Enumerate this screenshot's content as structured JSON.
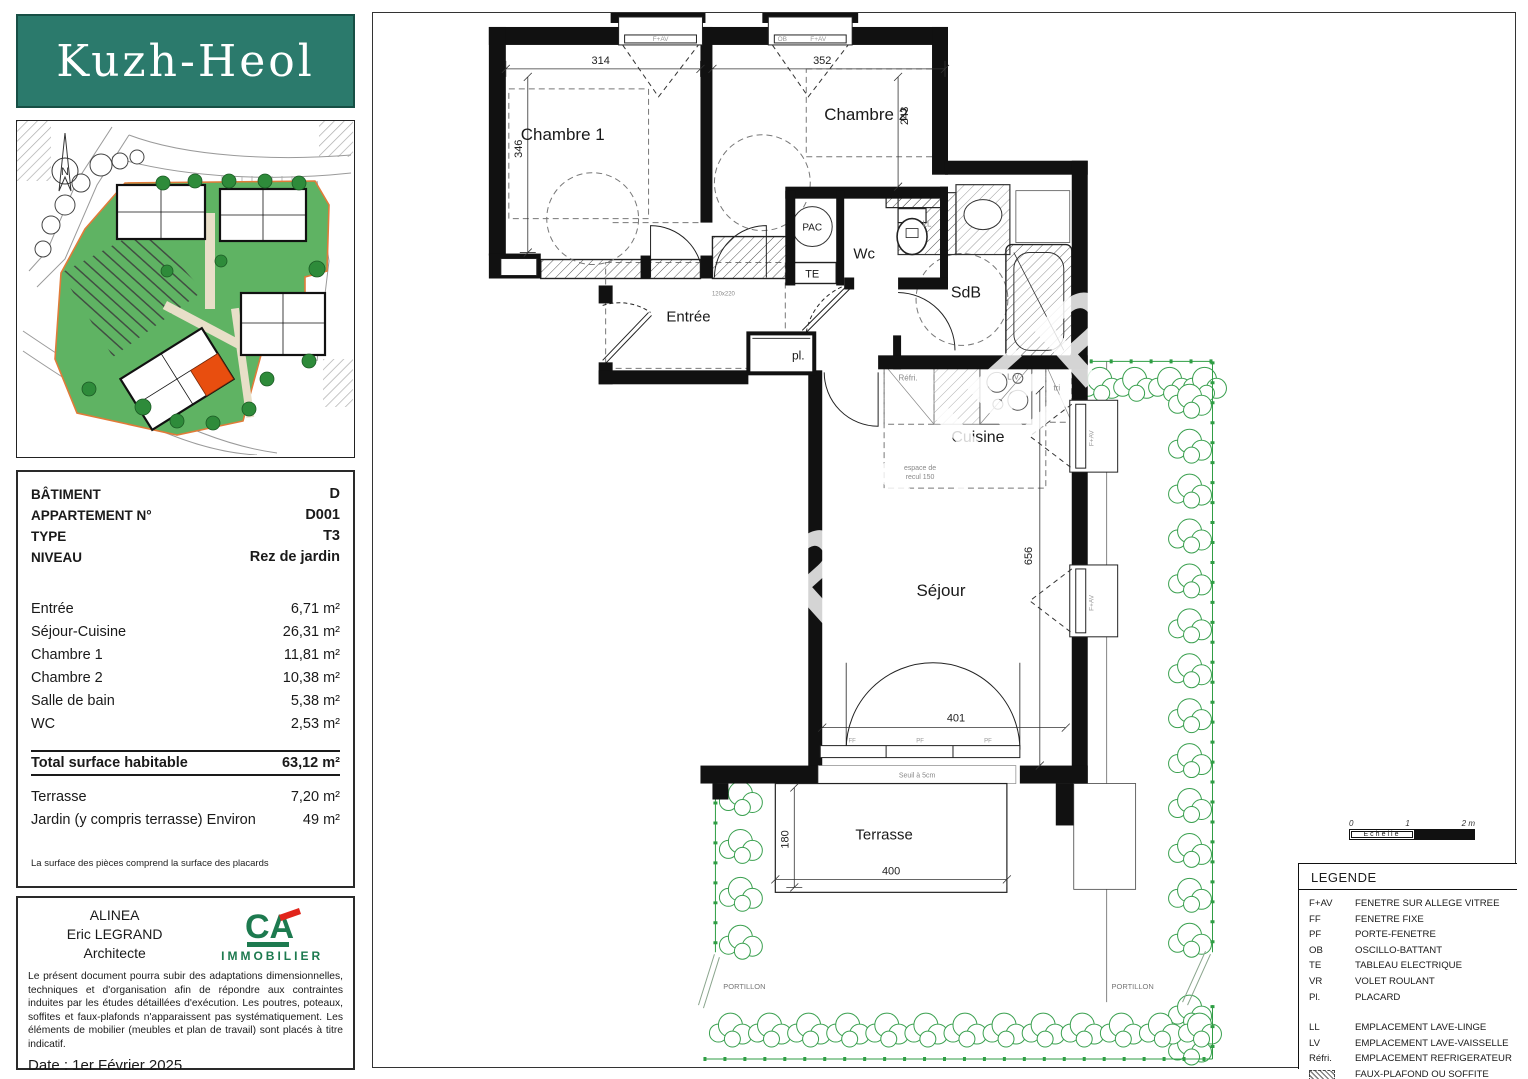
{
  "logo": {
    "title": "Kuzh-Heol"
  },
  "site_plan": {
    "north": "N"
  },
  "info_panel": {
    "header": [
      {
        "label": "BÂTIMENT",
        "value": "D"
      },
      {
        "label": "APPARTEMENT N°",
        "value": "D001"
      },
      {
        "label": "TYPE",
        "value": "T3"
      },
      {
        "label": "NIVEAU",
        "value": "Rez de jardin"
      }
    ],
    "rooms": [
      {
        "label": "Entrée",
        "value": "6,71 m²"
      },
      {
        "label": "Séjour-Cuisine",
        "value": "26,31 m²"
      },
      {
        "label": "Chambre 1",
        "value": "11,81 m²"
      },
      {
        "label": "Chambre 2",
        "value": "10,38 m²"
      },
      {
        "label": "Salle de bain",
        "value": "5,38 m²"
      },
      {
        "label": "WC",
        "value": "2,53 m²"
      }
    ],
    "total": {
      "label": "Total surface habitable",
      "value": "63,12 m²"
    },
    "outdoor": [
      {
        "label": "Terrasse",
        "value": "7,20 m²"
      },
      {
        "label": "Jardin (y compris terrasse) Environ",
        "value": "49 m²"
      }
    ],
    "footnote": "La surface des pièces comprend la surface des placards"
  },
  "architect_panel": {
    "line1": "ALINEA",
    "line2": "Eric LEGRAND",
    "line3": "Architecte",
    "ca": "CA",
    "immobilier": "IMMOBILIER",
    "disclaimer": "Le présent document pourra subir des adaptations dimensionnelles, techniques et d'organisation afin de répondre aux contraintes induites par les études détaillées d'exécution. Les poutres, poteaux, soffites et faux-plafonds n'apparaissent pas systématiquement. Les éléments de mobilier (meubles et plan de travail) sont placés à titre indicatif.",
    "date": "Date : 1er Février 2025"
  },
  "plan": {
    "rooms": {
      "c1": "Chambre 1",
      "c2": "Chambre 2",
      "entree": "Entrée",
      "wc": "Wc",
      "sdb": "SdB",
      "cuisine": "Cuisine",
      "sejour": "Séjour",
      "terrasse": "Terrasse"
    },
    "labels": {
      "pl": "pl.",
      "pac": "PAC",
      "te": "TE",
      "ll": "LL",
      "lv": "L.V.",
      "tri": "tri",
      "refri": "Réfri.",
      "recul1": "espace de",
      "recul2": "recul 150",
      "seuil": "Seuil à 5cm",
      "door_dim": "120x220",
      "portillon": "PORTILLON",
      "fav": "F+AV",
      "ob": "OB",
      "ff": "FF",
      "pf": "PF"
    },
    "dims": {
      "c1w": "314",
      "c2w": "352",
      "c1h": "346",
      "c2h": "243",
      "sej_h": "656",
      "sej_w": "401",
      "ter_h": "180",
      "ter_w": "400"
    },
    "watermark": "IMMOBILIER"
  },
  "scale_bar": {
    "t0": "0",
    "t1": "1",
    "t2": "2 m",
    "label": "Echelle"
  },
  "legend": {
    "title": "LEGENDE",
    "items": [
      {
        "abbr": "F+AV",
        "label": "FENETRE SUR ALLEGE VITREE"
      },
      {
        "abbr": "FF",
        "label": "FENETRE FIXE"
      },
      {
        "abbr": "PF",
        "label": "PORTE-FENETRE"
      },
      {
        "abbr": "OB",
        "label": "OSCILLO-BATTANT"
      },
      {
        "abbr": "TE",
        "label": "TABLEAU ELECTRIQUE"
      },
      {
        "abbr": "VR",
        "label": "VOLET ROULANT"
      },
      {
        "abbr": "Pl.",
        "label": "PLACARD"
      }
    ],
    "items2": [
      {
        "abbr": "LL",
        "label": "EMPLACEMENT LAVE-LINGE"
      },
      {
        "abbr": "LV",
        "label": "EMPLACEMENT LAVE-VAISSELLE"
      },
      {
        "abbr": "Réfri.",
        "label": "EMPLACEMENT REFRIGERATEUR"
      },
      {
        "abbr": "",
        "label": "FAUX-PLAFOND OU SOFFITE"
      }
    ]
  }
}
